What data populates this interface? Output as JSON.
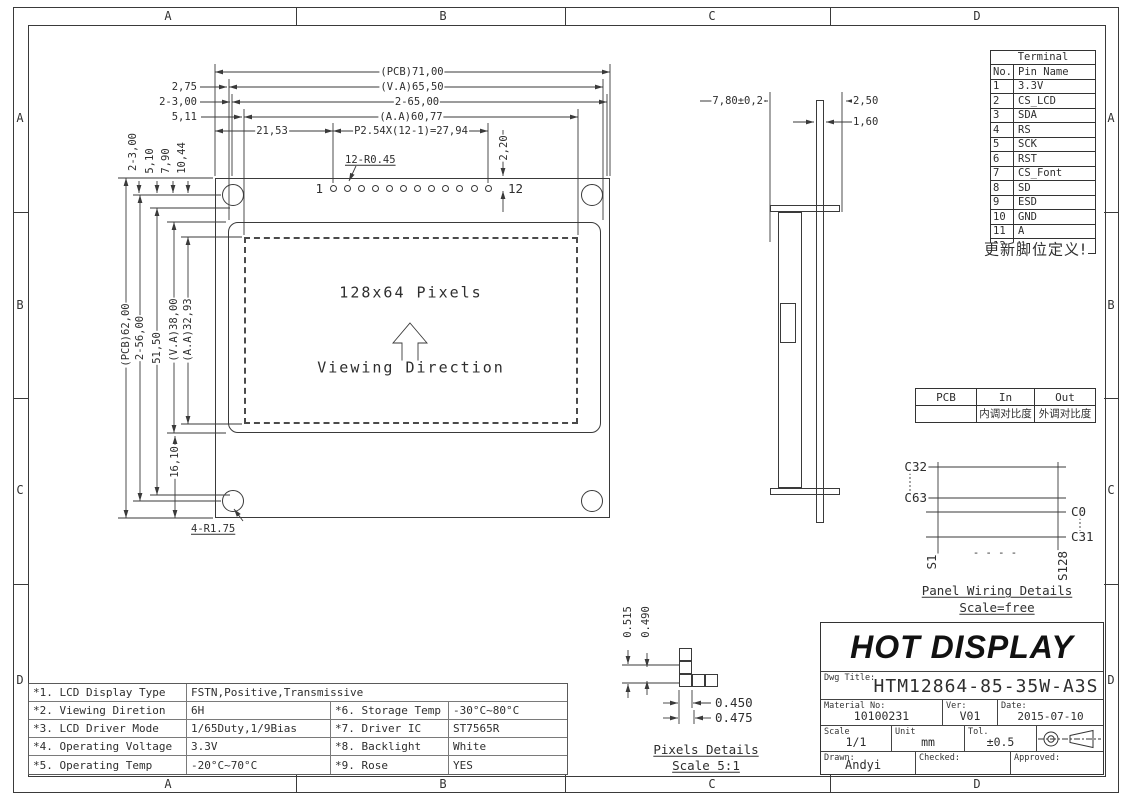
{
  "frame": {
    "cols": [
      "A",
      "B",
      "C",
      "D"
    ],
    "rows": [
      "A",
      "B",
      "C",
      "D"
    ]
  },
  "front": {
    "dim_pcb_w": "(PCB)71,00",
    "dim_va_w": "(V.A)65,50",
    "dim_2_65": "2-65,00",
    "dim_aa_w": "(A.A)60,77",
    "dim_2_75": "2,75",
    "dim_2_3_top": "2-3,00",
    "dim_5_11": "5,11",
    "dim_21_53": "21,53",
    "dim_pitch": "P2.54X(12-1)=27,94",
    "dim_12_r045": "12-R0.45",
    "dim_2_20": "2,20",
    "col_offsets": [
      "2-3,00",
      "5,10",
      "7,90",
      "10,44"
    ],
    "dim_pcb_h": "(PCB)62,00",
    "dim_2_56": "2-56,00",
    "dim_51_50": "51,50",
    "dim_va_h": "(V.A)38,00",
    "dim_aa_h": "(A.A)32,93",
    "dim_16_10": "16,10",
    "dim_4_r175": "4-R1.75",
    "pin_first": "1",
    "pin_last": "12",
    "lcd_pixels": "128x64 Pixels",
    "lcd_viewing": "Viewing Direction"
  },
  "side": {
    "dim_thickness": "7,80±0,2",
    "dim_2_50": "2,50",
    "dim_1_60": "1,60"
  },
  "terminal": {
    "title": "Terminal",
    "col_no": "No.",
    "col_name": "Pin Name",
    "rows": [
      {
        "no": "1",
        "name": "3.3V"
      },
      {
        "no": "2",
        "name": "CS_LCD"
      },
      {
        "no": "3",
        "name": "SDA"
      },
      {
        "no": "4",
        "name": "RS"
      },
      {
        "no": "5",
        "name": "SCK"
      },
      {
        "no": "6",
        "name": "RST"
      },
      {
        "no": "7",
        "name": "CS_Font"
      },
      {
        "no": "8",
        "name": "SD"
      },
      {
        "no": "9",
        "name": "ESD"
      },
      {
        "no": "10",
        "name": "GND"
      },
      {
        "no": "11",
        "name": "A"
      },
      {
        "no": "12",
        "name": "K"
      }
    ],
    "note": "更新脚位定义!"
  },
  "contrast": {
    "h_pcb": "PCB",
    "h_in": "In",
    "h_out": "Out",
    "in_cn": "内调对比度",
    "out_cn": "外调对比度"
  },
  "wiring": {
    "c32": "C32",
    "c63": "C63",
    "c0": "C0",
    "c31": "C31",
    "s1": "S1",
    "s128": "S128",
    "dashes": "- - - -",
    "title": "Panel Wiring Details",
    "scale": "Scale=free"
  },
  "pixels": {
    "dim_0515": "0.515",
    "dim_0490": "0.490",
    "dim_0450": "0.450",
    "dim_0475": "0.475",
    "title": "Pixels Details",
    "scale": "Scale 5:1"
  },
  "specs": {
    "rows": [
      {
        "k": "*1. LCD Display Type",
        "v": "FSTN,Positive,Transmissive"
      },
      {
        "k": "*2. Viewing Diretion",
        "v": "6H",
        "k2": "*6. Storage Temp",
        "v2": "-30°C~80°C"
      },
      {
        "k": "*3. LCD Driver Mode",
        "v": "1/65Duty,1/9Bias",
        "k2": "*7. Driver IC",
        "v2": "ST7565R"
      },
      {
        "k": "*4. Operating Voltage",
        "v": "3.3V",
        "k2": "*8. Backlight",
        "v2": "White"
      },
      {
        "k": "*5. Operating Temp",
        "v": "-20°C~70°C",
        "k2": "*9. Rose",
        "v2": "YES"
      }
    ]
  },
  "title_block": {
    "brand": "HOT DISPLAY",
    "dwg_label": "Dwg Title:",
    "dwg_no": "HTM12864-85-35W-A3S",
    "material_label": "Material No:",
    "material_no": "10100231",
    "ver_label": "Ver:",
    "ver": "V01",
    "date_label": "Date:",
    "date": "2015-07-10",
    "scale_label": "Scale",
    "scale": "1/1",
    "unit_label": "Unit",
    "unit": "mm",
    "tol_label": "Tol.",
    "tol": "±0.5",
    "drawn_label": "Drawn:",
    "drawn": "Andyi",
    "checked_label": "Checked:",
    "approved_label": "Approved:"
  }
}
